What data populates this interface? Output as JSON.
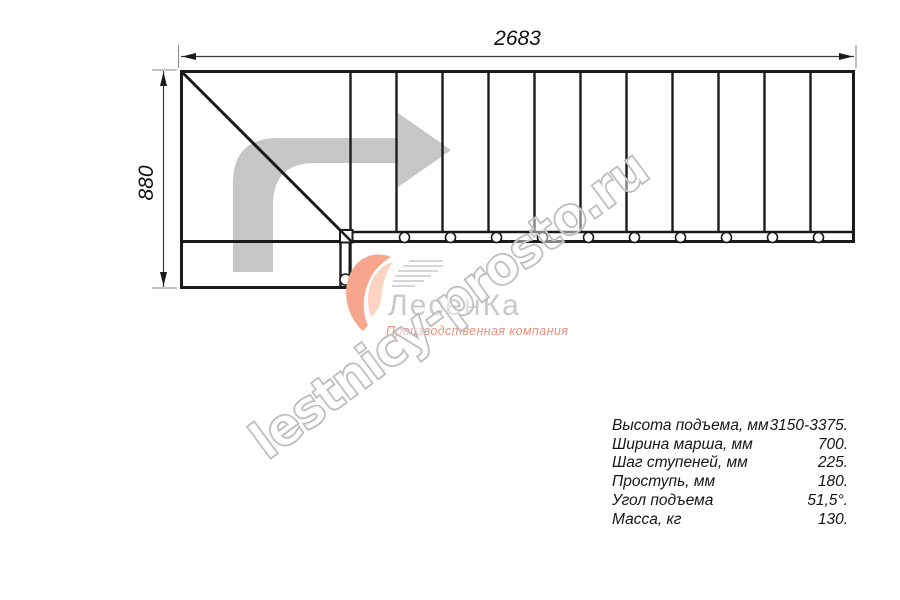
{
  "title": "Staircase plan drawing",
  "dimensions": {
    "overall_length_mm": "2683",
    "overall_depth_mm": "880"
  },
  "watermark": {
    "text": "lestnicy-prosto.ru"
  },
  "logo": {
    "name": "ЛесенКа",
    "subtitle": "Производственная компания",
    "swoosh_color": "#f6a68c",
    "name_color": "#c9c9c9"
  },
  "specs": {
    "rows": [
      {
        "label": "Высота подъема, мм",
        "value": "3150-3375."
      },
      {
        "label": "Ширина марша, мм",
        "value": "700."
      },
      {
        "label": "Шаг ступеней, мм",
        "value": "225."
      },
      {
        "label": "Проступь, мм",
        "value": "180."
      },
      {
        "label": "Угол подъема",
        "value": "51,5°."
      },
      {
        "label": "Масса, кг",
        "value": "130."
      }
    ]
  },
  "drawing": {
    "tread_count": 11,
    "baluster_count": 10,
    "line_color": "#1b1b1b",
    "direction_arrow_color": "#c6c6c6"
  }
}
